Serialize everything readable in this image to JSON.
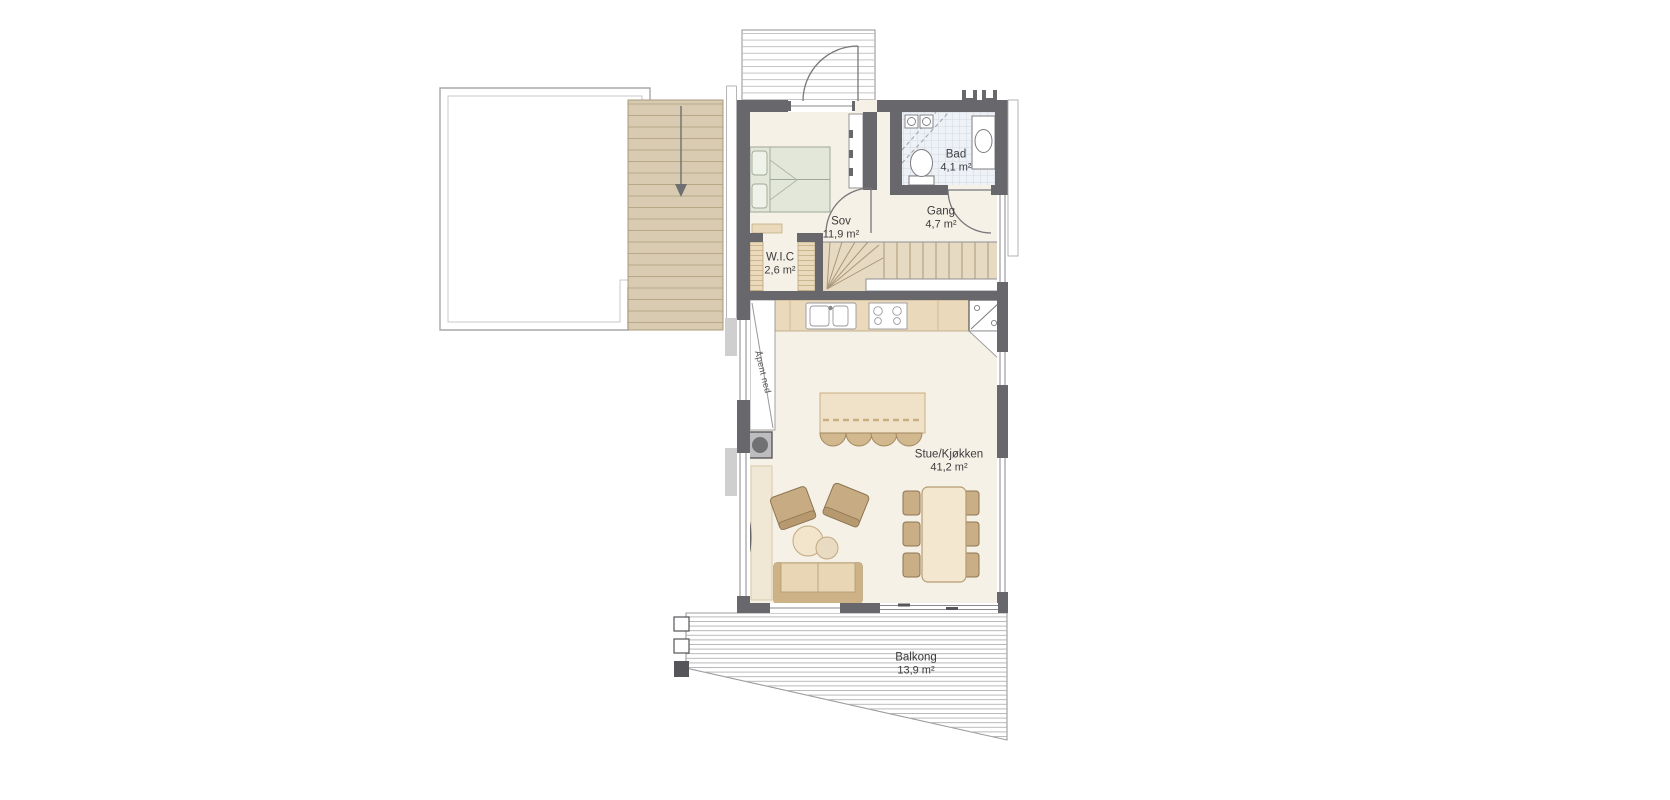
{
  "plan": {
    "title": "floor-plan",
    "rooms": [
      {
        "id": "sov",
        "name": "Sov",
        "area": "11,9 m²"
      },
      {
        "id": "bad",
        "name": "Bad",
        "area": "4,1 m²"
      },
      {
        "id": "gang",
        "name": "Gang",
        "area": "4,7 m²"
      },
      {
        "id": "wic",
        "name": "W.I.C",
        "area": "2,6 m²"
      },
      {
        "id": "stue",
        "name": "Stue/Kjøkken",
        "area": "41,2 m²"
      },
      {
        "id": "balkong",
        "name": "Balkong",
        "area": "13,9 m²"
      }
    ],
    "annotations": [
      {
        "id": "apent-ned",
        "text": "Åpent ned"
      }
    ],
    "palette": {
      "wall": "#68686c",
      "floor": "#f6f1e6",
      "wood_cabinet": "#ead9bb",
      "furniture_tan": "#c7ab82",
      "island_cream": "#efe2c8",
      "bed_green": "#e2e7d9",
      "bath_tile": "#eef1f6",
      "outdoor_stair": "#d8cbb1",
      "hatch_line": "#b0b0b0",
      "text": "#3c3c3e"
    }
  }
}
